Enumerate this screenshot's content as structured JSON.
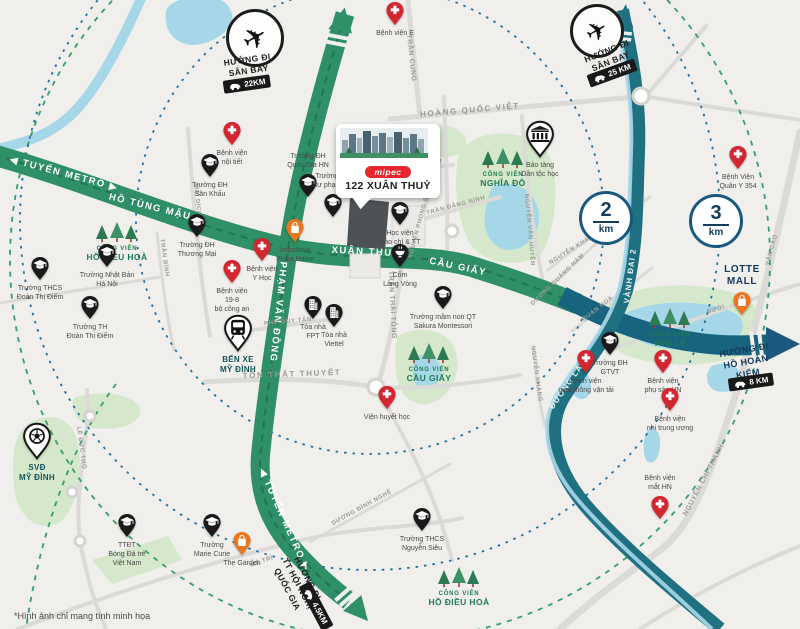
{
  "map_note": "*Hình ảnh chỉ mang tính minh họa",
  "project": {
    "brand": "mipec",
    "title": "122 XUÂN THUỶ"
  },
  "colors": {
    "road_green": "#2f8f66",
    "road_teal": "#1f7080",
    "road_navy": "#1b5a7e",
    "river_blue": "#a6d7e9",
    "park_green": "#d5e8cb",
    "hospital_red": "#d22630",
    "mall_orange": "#e87722",
    "navy_text": "#123a5e"
  },
  "distance_badges": [
    {
      "value": "2",
      "unit": "km",
      "x": 606,
      "y": 218
    },
    {
      "value": "3",
      "unit": "km",
      "x": 716,
      "y": 221
    }
  ],
  "direction_signs": [
    {
      "id": "airport-northwest",
      "icon": "airplane",
      "circle": {
        "x": 255,
        "y": 38,
        "r": 26
      },
      "text": {
        "x": 248,
        "y": 66,
        "rot": -8,
        "lines": "HƯỚNG ĐI\nSÂN BAY"
      },
      "badge": {
        "x": 247,
        "y": 84,
        "rot": -8,
        "km": "22KM"
      }
    },
    {
      "id": "airport-northeast",
      "icon": "airplane",
      "circle": {
        "x": 597,
        "y": 31,
        "r": 24
      },
      "text": {
        "x": 609,
        "y": 57,
        "rot": -22,
        "lines": "HƯỚNG ĐI\nSÂN BAY"
      },
      "badge": {
        "x": 612,
        "y": 73,
        "rot": -20,
        "km": "25 KM"
      }
    },
    {
      "id": "hoan-kiem-lake",
      "text": {
        "x": 746,
        "y": 362,
        "rot": -10,
        "cls": "navy",
        "lines": "HƯỚNG ĐI\nHỒ HOÀN KIẾM"
      },
      "badge": {
        "x": 751,
        "y": 382,
        "rot": -8,
        "km": "8 KM"
      }
    },
    {
      "id": "national-convention-center",
      "text": {
        "x": 297,
        "y": 584,
        "rot": 62,
        "lines": "HƯỚNG ĐI\nTT HỘI NGHỊ\nQUỐC GIA"
      },
      "badge": {
        "x": 316,
        "y": 606,
        "rot": 62,
        "km": "4.5KM"
      }
    }
  ],
  "road_labels": [
    {
      "text": "◀ TUYẾN METRO ▶",
      "x": 64,
      "y": 174,
      "rot": 15,
      "cls": "rl-green"
    },
    {
      "text": "HỒ TÙNG MẬU",
      "x": 150,
      "y": 207,
      "rot": 14,
      "cls": "rl-green"
    },
    {
      "text": "XUÂN THUỶ",
      "x": 366,
      "y": 252,
      "rot": 3,
      "cls": "rl-green"
    },
    {
      "text": "CẦU GIẤY",
      "x": 458,
      "y": 267,
      "rot": 12,
      "cls": "rl-green"
    },
    {
      "text": "PHẠM VĂN ĐỒNG",
      "x": 278,
      "y": 312,
      "rot": 96,
      "cls": "rl-green"
    },
    {
      "text": "◀ TUYẾN METRO ▶",
      "x": 284,
      "y": 520,
      "rot": 66,
      "cls": "rl-green"
    },
    {
      "text": "VÀNH ĐAI 2",
      "x": 630,
      "y": 276,
      "rot": -83,
      "cls": "rl-teal"
    },
    {
      "text": "ĐƯỜNG LÁNG",
      "x": 570,
      "y": 381,
      "rot": -55,
      "cls": "rl-teal"
    },
    {
      "text": "TRẦN CUNG",
      "x": 411,
      "y": 58,
      "rot": 84,
      "cls": "rl-gray"
    },
    {
      "text": "HOÀNG QUỐC VIỆT",
      "x": 470,
      "y": 110,
      "rot": -5,
      "cls": "rl-gray lg"
    },
    {
      "text": "TÔ HIỆU",
      "x": 428,
      "y": 163,
      "rot": -5,
      "cls": "rl-gray sm"
    },
    {
      "text": "TRẦN ĐĂNG NINH",
      "x": 456,
      "y": 206,
      "rot": -15,
      "cls": "rl-gray sm"
    },
    {
      "text": "NGUYỄN PHONG SẮC",
      "x": 420,
      "y": 223,
      "rot": -75,
      "cls": "rl-gray sm"
    },
    {
      "text": "NGUYỄN VĂN HUYÊN",
      "x": 529,
      "y": 230,
      "rot": 85,
      "cls": "rl-gray sm"
    },
    {
      "text": "TRẦN THÁI TÔNG",
      "x": 392,
      "y": 305,
      "rot": 87,
      "cls": "rl-gray"
    },
    {
      "text": "PHỐ DUY TÂN",
      "x": 288,
      "y": 322,
      "rot": -5,
      "cls": "rl-gray sm"
    },
    {
      "text": "TÔN THẤT THUYẾT",
      "x": 292,
      "y": 374,
      "rot": -2,
      "cls": "rl-gray lg"
    },
    {
      "text": "NGUYỄN KHÁNH TOÀN",
      "x": 583,
      "y": 243,
      "rot": -32,
      "cls": "rl-gray sm"
    },
    {
      "text": "DƯƠNG QUẢNG HÀM",
      "x": 558,
      "y": 280,
      "rot": -44,
      "cls": "rl-gray sm"
    },
    {
      "text": "QUAN HOA",
      "x": 598,
      "y": 309,
      "rot": -38,
      "cls": "rl-gray sm"
    },
    {
      "text": "NGUYỄN KHANG",
      "x": 536,
      "y": 374,
      "rot": 82,
      "cls": "rl-gray sm"
    },
    {
      "text": "BƯỞI",
      "x": 716,
      "y": 310,
      "rot": -16,
      "cls": "rl-gray sm"
    },
    {
      "text": "VĂN CAO",
      "x": 772,
      "y": 250,
      "rot": -74,
      "cls": "rl-gray sm"
    },
    {
      "text": "NGUYỄN CHÍ THANH",
      "x": 704,
      "y": 480,
      "rot": -62,
      "cls": "rl-gray"
    },
    {
      "text": "DƯƠNG ĐÌNH NGHỆ",
      "x": 362,
      "y": 508,
      "rot": -29,
      "cls": "rl-gray sm"
    },
    {
      "text": "MAI DỊCH",
      "x": 197,
      "y": 200,
      "rot": 85,
      "cls": "rl-gray sm"
    },
    {
      "text": "TRẦN BÌNH",
      "x": 164,
      "y": 258,
      "rot": 82,
      "cls": "rl-gray sm"
    },
    {
      "text": "LÊ ĐỨC THỌ",
      "x": 81,
      "y": 448,
      "rot": 82,
      "cls": "rl-gray sm"
    },
    {
      "text": "MỄ TRÌ",
      "x": 262,
      "y": 562,
      "rot": -20,
      "cls": "rl-gray sm"
    }
  ],
  "parks": [
    {
      "prefix": "CÔNG VIÊN",
      "name": "NGHĨA ĐÔ",
      "x": 503,
      "y": 170
    },
    {
      "prefix": "CÔNG VIÊN",
      "name": "THỦ LỆ",
      "x": 670,
      "y": 330
    },
    {
      "prefix": "CÔNG VIÊN",
      "name": "CẦU GIẤY",
      "x": 429,
      "y": 365
    },
    {
      "prefix": "CÔNG VIÊN",
      "name": "HỒ ĐIỀU HOÀ",
      "x": 117,
      "y": 244
    },
    {
      "prefix": "CÔNG VIÊN",
      "name": "HỒ ĐIỀU HOÀ",
      "x": 459,
      "y": 589
    }
  ],
  "pois": [
    {
      "type": "hospital",
      "x": 395,
      "y": 26,
      "label": "Bệnh viện E"
    },
    {
      "type": "hospital",
      "x": 232,
      "y": 146,
      "label": "Bệnh viện\nnội tiết"
    },
    {
      "type": "hospital",
      "x": 262,
      "y": 262,
      "label": "Bệnh viện\nY Học"
    },
    {
      "type": "hospital",
      "x": 232,
      "y": 284,
      "label": "Bệnh viện\n19-8\nbộ công an"
    },
    {
      "type": "hospital",
      "x": 738,
      "y": 170,
      "label": "Bệnh Viện\nQuân Y 354"
    },
    {
      "type": "hospital",
      "x": 586,
      "y": 374,
      "label": "Bệnh viện\ngiao thông vận tải"
    },
    {
      "type": "hospital",
      "x": 663,
      "y": 374,
      "label": "Bệnh viện\nphụ sản HN"
    },
    {
      "type": "hospital",
      "x": 670,
      "y": 412,
      "label": "Bệnh viện\nnhi trung ương"
    },
    {
      "type": "hospital",
      "x": 660,
      "y": 520,
      "label": "Bệnh viện\nmắt HN",
      "la": 1
    },
    {
      "type": "hospital",
      "x": 387,
      "y": 410,
      "label": "Viện huyết học"
    },
    {
      "type": "school",
      "x": 210,
      "y": 178,
      "label": "Trường ĐH\nSân Khấu"
    },
    {
      "type": "school",
      "x": 308,
      "y": 198,
      "label": "Trường ĐH\nQuốc Gia HN",
      "la": 1
    },
    {
      "type": "school",
      "x": 333,
      "y": 218,
      "label": "Trường ĐH\nSư phạm HN",
      "la": 1
    },
    {
      "type": "school",
      "x": 197,
      "y": 238,
      "label": "Trường ĐH\nThương Mại"
    },
    {
      "type": "school",
      "x": 107,
      "y": 268,
      "label": "Trường Nhật Bản\nHà Nội"
    },
    {
      "type": "school",
      "x": 40,
      "y": 281,
      "label": "Trường THCS\nĐoàn Thị Điểm"
    },
    {
      "type": "school",
      "x": 90,
      "y": 320,
      "label": "Trường TH\nĐoàn Thị Điểm"
    },
    {
      "type": "school",
      "x": 400,
      "y": 226,
      "label": "Học viện\nBáo chí & TT"
    },
    {
      "type": "bowl",
      "x": 400,
      "y": 268,
      "label": "Cốm\nLàng Vòng"
    },
    {
      "type": "office",
      "x": 313,
      "y": 320,
      "label": "Tòa nhà\nFPT"
    },
    {
      "type": "office",
      "x": 334,
      "y": 328,
      "label": "Tòa nhà\nViettel"
    },
    {
      "type": "school",
      "x": 443,
      "y": 310,
      "label": "Trường mầm non QT\nSakura Montessori"
    },
    {
      "type": "school",
      "x": 610,
      "y": 356,
      "label": "Trường ĐH\nGTVT"
    },
    {
      "type": "school",
      "x": 422,
      "y": 532,
      "label": "Trường THCS\nNguyễn Siêu"
    },
    {
      "type": "school",
      "x": 127,
      "y": 538,
      "label": "TTĐT\nBóng Đá trẻ\nViệt Nam"
    },
    {
      "type": "school",
      "x": 212,
      "y": 538,
      "label": "Trường\nMarie Curie"
    },
    {
      "type": "museum",
      "x": 540,
      "y": 158,
      "label": "Bảo tàng\nDân tộc học",
      "big": 1
    },
    {
      "type": "bus",
      "x": 238,
      "y": 352,
      "label": "BẾN XE\nMỸ ĐÌNH",
      "big": 1,
      "cls": "strong"
    },
    {
      "type": "soccer",
      "x": 37,
      "y": 460,
      "label": "SVĐ\nMỸ ĐÌNH",
      "big": 1,
      "cls": "strong"
    },
    {
      "type": "mall",
      "x": 295,
      "y": 243,
      "label": "Indochina\nPlaza Hanoi"
    },
    {
      "type": "mall",
      "x": 742,
      "y": 316,
      "label": "LOTTE\nMALL",
      "la": 1,
      "cls": "lotte"
    },
    {
      "type": "mall",
      "x": 242,
      "y": 556,
      "label": "The Garden"
    }
  ]
}
